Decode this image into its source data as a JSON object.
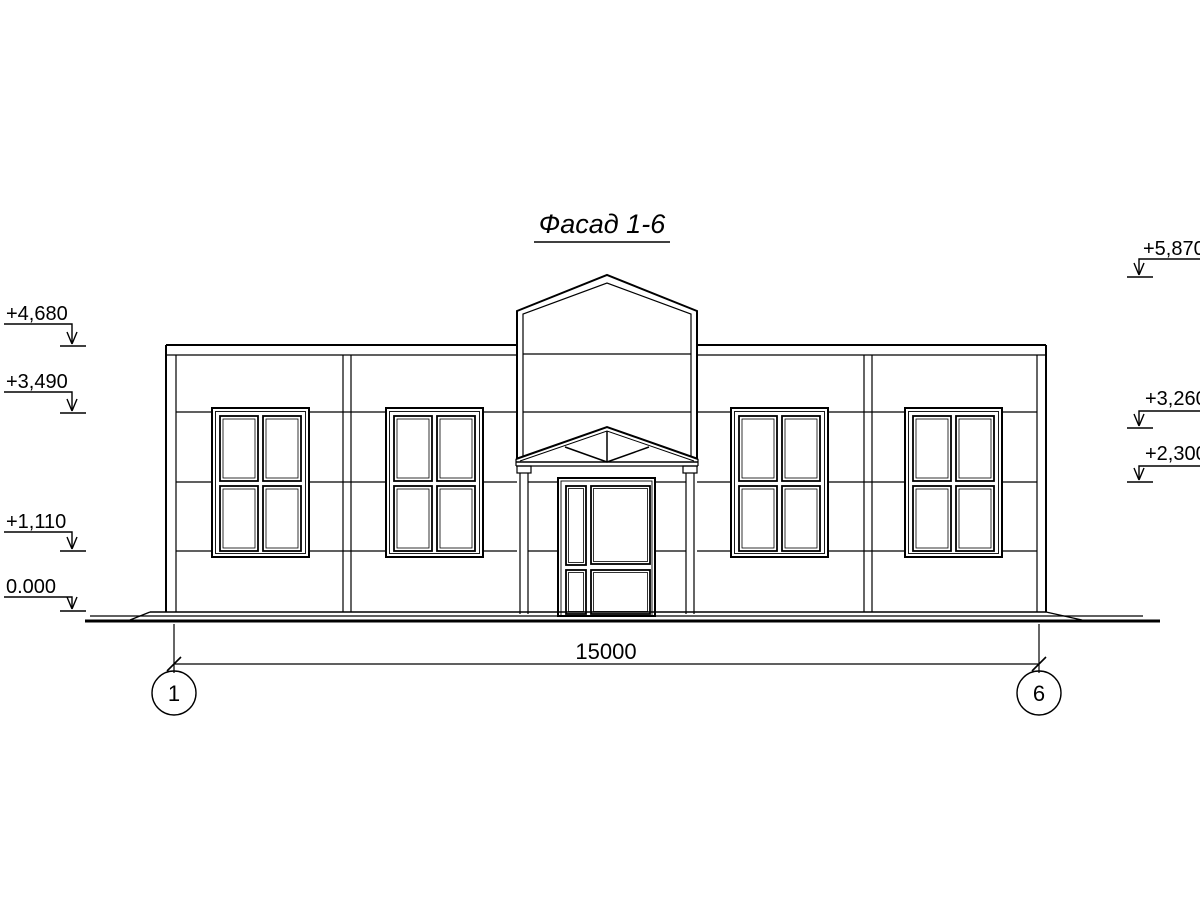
{
  "title": "Фасад 1-6",
  "elevation_marks": {
    "left": [
      {
        "label": "+4,680"
      },
      {
        "label": "+3,490"
      },
      {
        "label": "+1,110"
      },
      {
        "label": "0.000"
      }
    ],
    "right": [
      {
        "label": "+5,870"
      },
      {
        "label": "+3,260"
      },
      {
        "label": "+2,300"
      }
    ]
  },
  "dimension": {
    "length_label": "15000"
  },
  "axes": {
    "left_label": "1",
    "right_label": "6"
  },
  "colors": {
    "line": "#000000",
    "background": "#ffffff"
  }
}
